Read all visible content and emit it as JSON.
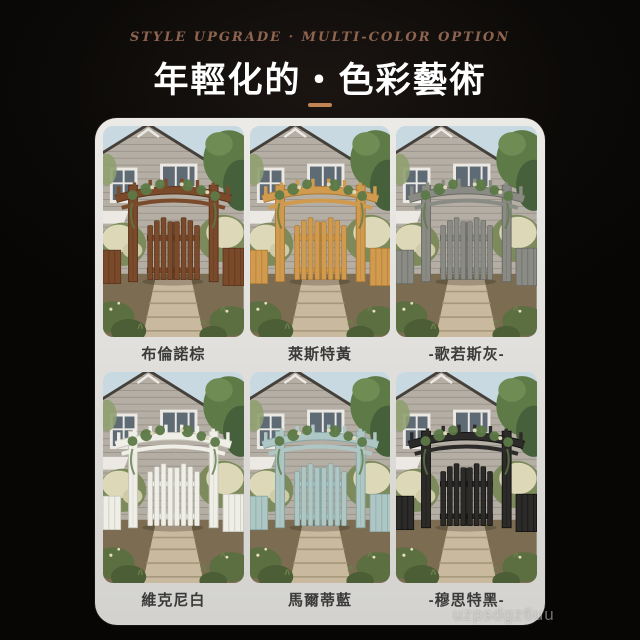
{
  "header": {
    "tagline": "STYLE UPGRADE · MULTI-COLOR OPTION",
    "title": "年輕化的・色彩藝術",
    "accent_color": "#c08553"
  },
  "card": {
    "tiles": [
      {
        "label": "布倫諾棕",
        "arch_color": "#7b4a2b",
        "arch_dark": "#59341d"
      },
      {
        "label": "萊斯特黃",
        "arch_color": "#d19b4f",
        "arch_dark": "#ad7a34"
      },
      {
        "label": "-歌若斯灰-",
        "arch_color": "#8b8b85",
        "arch_dark": "#6a6a64"
      },
      {
        "label": "維克尼白",
        "arch_color": "#efeee7",
        "arch_dark": "#c6c5bb"
      },
      {
        "label": "馬爾蒂藍",
        "arch_color": "#aec7c5",
        "arch_dark": "#86a5a3"
      },
      {
        "label": "-穆思特黑-",
        "arch_color": "#2c2b29",
        "arch_dark": "#121210"
      }
    ],
    "scene": {
      "sky": "#c9d9e1",
      "shingle": "#b4aea4",
      "shingle_line": "#9a948b",
      "roof_edge": "#45403a",
      "trim": "#ece9e4",
      "glass": "#5e6a74",
      "tree": "#5d7a47",
      "tree_dark": "#45603a",
      "tree_light": "#6f8c55",
      "bush_pale": "#ddd8b8",
      "bush_green": "#7c8a5c",
      "ground": "#7b6c52",
      "path": "#c9b99f",
      "path_line": "#a5977b",
      "plant": "#5c6f41",
      "plant_dark": "#4c5e36"
    }
  },
  "watermark": "uzpsdgz6uu"
}
